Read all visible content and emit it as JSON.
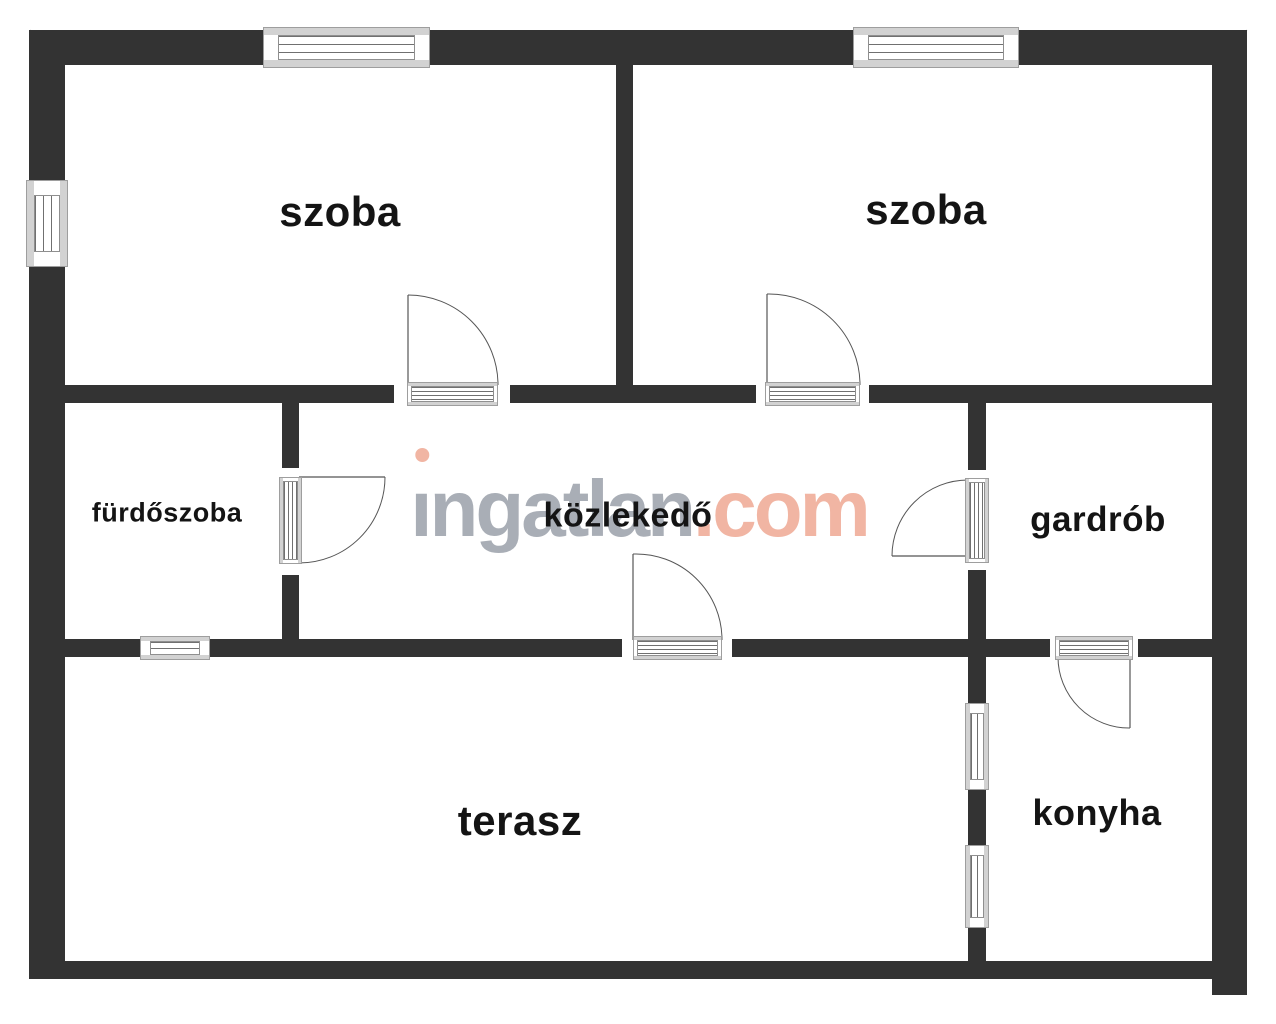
{
  "watermark": {
    "brand_gray": "ingatlan",
    "brand_accent": ".com",
    "gray_color": "#a9aeb6",
    "accent_color": "#f1b5a3"
  },
  "rooms": [
    {
      "id": "szoba-1",
      "label": "szoba",
      "cx": 340,
      "cy": 212,
      "size": 42
    },
    {
      "id": "szoba-2",
      "label": "szoba",
      "cx": 926,
      "cy": 210,
      "size": 42
    },
    {
      "id": "furdoszoba",
      "label": "fürdőszoba",
      "cx": 167,
      "cy": 513,
      "size": 27
    },
    {
      "id": "kozlekedo",
      "label": "közlekedő",
      "cx": 628,
      "cy": 516,
      "size": 34
    },
    {
      "id": "gardrob",
      "label": "gardrób",
      "cx": 1098,
      "cy": 520,
      "size": 35
    },
    {
      "id": "terasz",
      "label": "terasz",
      "cx": 520,
      "cy": 821,
      "size": 42
    },
    {
      "id": "konyha",
      "label": "konyha",
      "cx": 1097,
      "cy": 813,
      "size": 36
    }
  ],
  "floorplan": {
    "wall_color": "#333333",
    "sill_color": "#d2d2d2",
    "frame_color": "#8f8f8f",
    "line_color": "#707070",
    "arc_color": "#555555",
    "chamfer_color": "#9a9a9a",
    "walls": [
      {
        "x": 30,
        "y": 30,
        "w": 233,
        "h": 35
      },
      {
        "x": 430,
        "y": 30,
        "w": 423,
        "h": 35
      },
      {
        "x": 1019,
        "y": 30,
        "w": 228,
        "h": 35
      },
      {
        "x": 29,
        "y": 30,
        "w": 36,
        "h": 150
      },
      {
        "x": 29,
        "y": 267,
        "w": 36,
        "h": 712
      },
      {
        "x": 1212,
        "y": 30,
        "w": 35,
        "h": 965
      },
      {
        "x": 29,
        "y": 961,
        "w": 1183,
        "h": 18
      },
      {
        "x": 616,
        "y": 65,
        "w": 17,
        "h": 320
      },
      {
        "x": 65,
        "y": 385,
        "w": 329,
        "h": 18
      },
      {
        "x": 510,
        "y": 385,
        "w": 246,
        "h": 18
      },
      {
        "x": 869,
        "y": 385,
        "w": 343,
        "h": 18
      },
      {
        "x": 282,
        "y": 403,
        "w": 17,
        "h": 65
      },
      {
        "x": 282,
        "y": 575,
        "w": 17,
        "h": 64
      },
      {
        "x": 968,
        "y": 403,
        "w": 18,
        "h": 67
      },
      {
        "x": 968,
        "y": 570,
        "w": 18,
        "h": 69
      },
      {
        "x": 65,
        "y": 639,
        "w": 75,
        "h": 18
      },
      {
        "x": 210,
        "y": 639,
        "w": 412,
        "h": 18
      },
      {
        "x": 732,
        "y": 639,
        "w": 318,
        "h": 18
      },
      {
        "x": 1138,
        "y": 639,
        "w": 74,
        "h": 18
      },
      {
        "x": 968,
        "y": 657,
        "w": 18,
        "h": 46
      },
      {
        "x": 968,
        "y": 790,
        "w": 18,
        "h": 55
      },
      {
        "x": 968,
        "y": 928,
        "w": 18,
        "h": 33
      }
    ],
    "windows": [
      {
        "o": "h",
        "x": 263,
        "y": 30,
        "w": 167,
        "h": 35
      },
      {
        "o": "h",
        "x": 853,
        "y": 30,
        "w": 166,
        "h": 35
      },
      {
        "o": "h",
        "x": 140,
        "y": 639,
        "w": 70,
        "h": 18
      },
      {
        "o": "v",
        "x": 29,
        "y": 180,
        "w": 36,
        "h": 87
      },
      {
        "o": "v",
        "x": 968,
        "y": 703,
        "w": 18,
        "h": 87
      },
      {
        "o": "v",
        "x": 968,
        "y": 845,
        "w": 18,
        "h": 83
      }
    ],
    "thresholds": [
      {
        "o": "h",
        "x": 407,
        "y": 385,
        "w": 91,
        "h": 18
      },
      {
        "o": "h",
        "x": 765,
        "y": 385,
        "w": 95,
        "h": 18
      },
      {
        "o": "v",
        "x": 282,
        "y": 477,
        "w": 17,
        "h": 87
      },
      {
        "o": "v",
        "x": 968,
        "y": 478,
        "w": 18,
        "h": 85
      },
      {
        "o": "h",
        "x": 633,
        "y": 639,
        "w": 89,
        "h": 18
      },
      {
        "o": "h",
        "x": 1055,
        "y": 639,
        "w": 78,
        "h": 18
      }
    ],
    "doors": [
      {
        "hinge": [
          408,
          385
        ],
        "tip": [
          408,
          295
        ],
        "end": [
          498,
          385
        ]
      },
      {
        "hinge": [
          767,
          385
        ],
        "tip": [
          767,
          294
        ],
        "end": [
          860,
          385
        ]
      },
      {
        "hinge": [
          299,
          477
        ],
        "tip": [
          385,
          477
        ],
        "end": [
          299,
          563
        ]
      },
      {
        "hinge": [
          968,
          556
        ],
        "tip": [
          892,
          556
        ],
        "end": [
          968,
          480
        ]
      },
      {
        "hinge": [
          633,
          640
        ],
        "tip": [
          633,
          554
        ],
        "end": [
          722,
          640
        ]
      },
      {
        "hinge": [
          1130,
          657
        ],
        "tip": [
          1130,
          728
        ],
        "end": [
          1058,
          657
        ]
      }
    ],
    "chamfers": [
      [
        30,
        30,
        64,
        64
      ],
      [
        1247,
        30,
        1213,
        64
      ]
    ]
  }
}
